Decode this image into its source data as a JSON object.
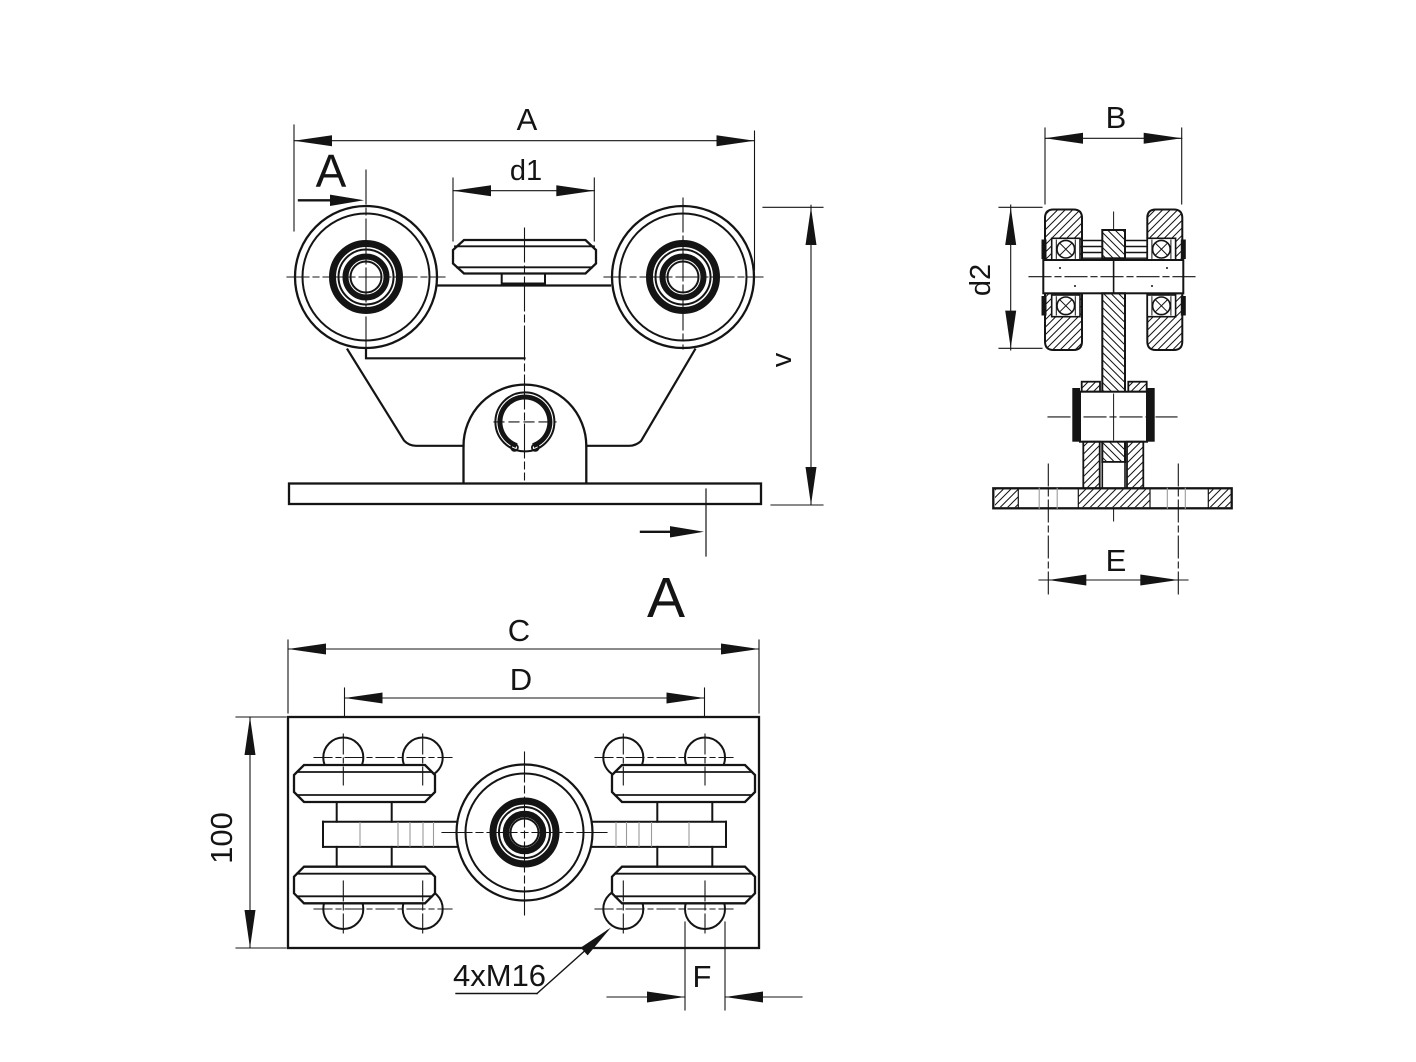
{
  "drawing": {
    "background": "#ffffff",
    "line_color": "#141414",
    "thread_line_color": "#9a9a9a",
    "front_view": {
      "dim_overall_width": "A",
      "dim_pad_width": "d1",
      "dim_height": "v",
      "section_label_top": "A",
      "section_label_bottom": "A"
    },
    "section_view": {
      "dim_width": "B",
      "dim_wheel_diameter": "d2",
      "dim_hole_spacing": "E"
    },
    "plan_view": {
      "dim_plate_length": "C",
      "dim_bolt_span": "D",
      "dim_plate_width": "100",
      "dim_hole": "F",
      "thread_callout": "4xM16"
    }
  }
}
